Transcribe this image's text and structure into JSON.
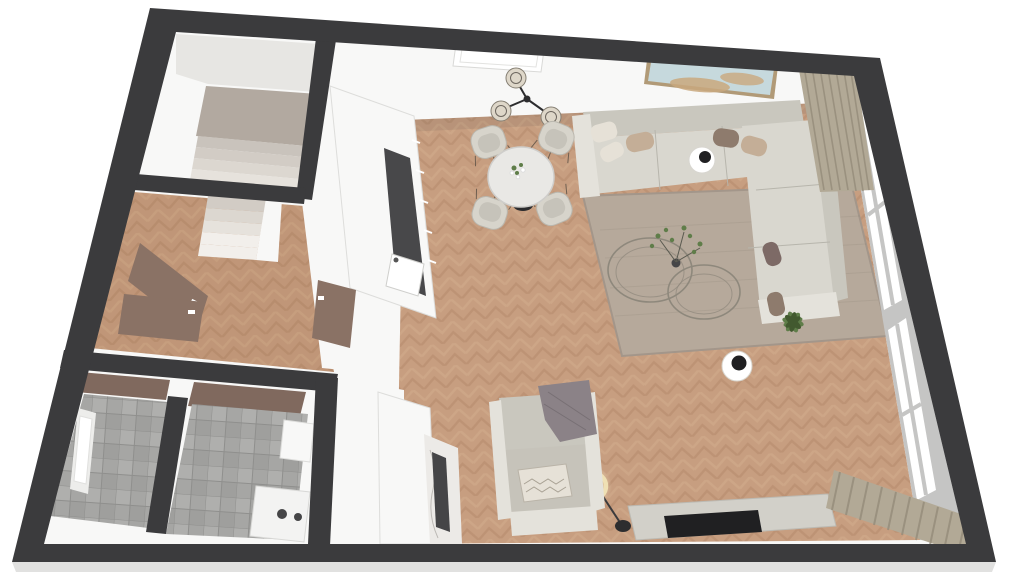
{
  "scene": {
    "description": "3D isometric floor plan render of an apartment, top-down view",
    "rooms": [
      {
        "name": "living-dining-room",
        "floor": "herringbone-wood"
      },
      {
        "name": "kitchen",
        "floor": "herringbone-wood"
      },
      {
        "name": "hallway",
        "floor": "herringbone-wood"
      },
      {
        "name": "stairwell",
        "floor": "light-concrete"
      },
      {
        "name": "bathroom",
        "floor": "grey-tile"
      },
      {
        "name": "utility-room",
        "floor": "grey-tile"
      }
    ],
    "furniture": [
      "corner-sofa",
      "throw-pillows",
      "round-side-table",
      "area-rug",
      "nesting-coffee-tables",
      "potted-plant",
      "dining-table",
      "dining-chairs",
      "pendant-chandelier",
      "wall-art",
      "window-wall",
      "curtains",
      "armchair",
      "throw-blanket",
      "ring-floor-lamp",
      "tv-bench",
      "tv",
      "marble-media-unit",
      "kitchen-cabinets",
      "kitchen-sink",
      "staircase",
      "interior-doors",
      "washing-machine",
      "top-wall-window",
      "bathroom-window",
      "round-stool-table"
    ]
  },
  "palette": {
    "background": "#ffffff",
    "wallDark": "#3b3b3d",
    "groundShadow": "#d9d9d8",
    "interiorWhite": "#f8f8f7",
    "wallFaceShade": "#e7e6e3",
    "woodBase": "#c79e80",
    "woodDark": "#b4886a",
    "woodLight": "#d6af91",
    "hallTint": "#8a5a34",
    "tileBase": "#a6a6a4",
    "tileGrout": "#8f8f8d",
    "tileLight": "#b7b7b5",
    "tileDark": "#979795",
    "stairLanding": "#b2a9a0",
    "sofaBase": "#d9d7cf",
    "sofaBack": "#c9c7be",
    "sofaArm": "#e4e2db",
    "seam": "#b7b5ac",
    "pillowTan": "#c4ae97",
    "pillowCream": "#e6e1d7",
    "pillowBrown": "#8e7b6d",
    "pillowMauve": "#7d6a66",
    "rugBase": "#b6a99b",
    "rugEdge": "#a3968a",
    "curtain": "#b2a996",
    "curtainShade": "#948b79",
    "doorBrown": "#8a7265",
    "doorDark": "#80695e",
    "windowFrame": "#c5c5c4",
    "glassWhite": "#ffffff",
    "tableTop": "#e9e8e5",
    "tableBase": "#2c2c2e",
    "chairShell": "#d7d4cb",
    "chairSeat": "#c6c3ba",
    "legBrown": "#6f5f50",
    "metalDark": "#2d2d2f",
    "glassStroke": "#8e887c",
    "plantGreen": "#5f7d49",
    "plantDeep": "#42592f",
    "artSky": "#c6d9dd",
    "artSand": "#c9a87e",
    "artFrame": "#b19a77",
    "marbleBase": "#eceae7",
    "marbleVein": "#bcb9b5",
    "insetDark": "#454547",
    "counterDark": "#48484a",
    "benchGrey": "#d2d0c9",
    "tvBlack": "#202022",
    "blanketGrey": "#8b8287",
    "washerWhite": "#f3f3f2",
    "lampGlow": "#f6ecc9",
    "lampRing": "#efe0b4",
    "stepA": "#c9c3bc",
    "stepB": "#d2ccc5",
    "stepC": "#dcd7d0",
    "stepD": "#e6e2dc",
    "stepE": "#f2efeb"
  }
}
